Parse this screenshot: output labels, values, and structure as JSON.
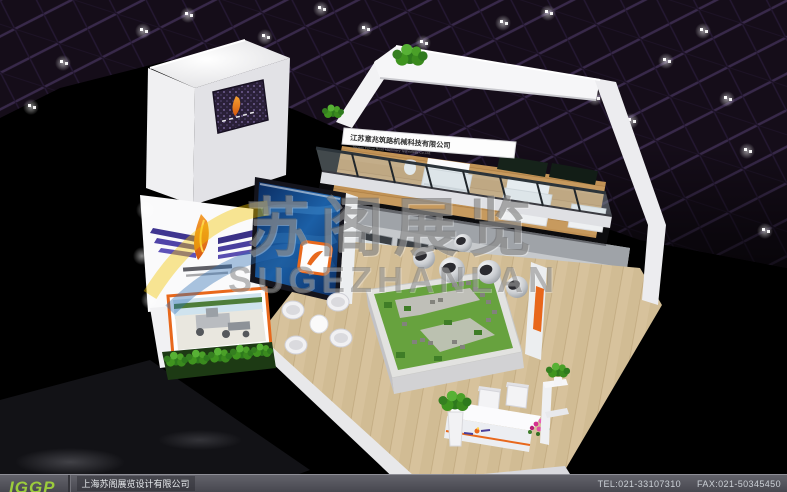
{
  "booth": {
    "fascia_cn": "江苏意兆筑路机械科技有限公司",
    "fascia_en": "Jiangsu Yizhao Road Machinery Technology Co.,Ltd."
  },
  "watermark": {
    "cn": "苏阁展览",
    "en": "SUGEZHANLAN"
  },
  "footer": {
    "logo_text": "IGGP",
    "company": "上海苏阁展览设计有限公司",
    "tel": "TEL:021-33107310",
    "fax": "FAX:021-50345450"
  },
  "colors": {
    "accent_orange": "#e8671b",
    "screen_blue": "#1b5fa6",
    "footer_green": "#9ccc3c",
    "wood": "#d7c29c",
    "watermark_gray": "#6e6e6e"
  }
}
